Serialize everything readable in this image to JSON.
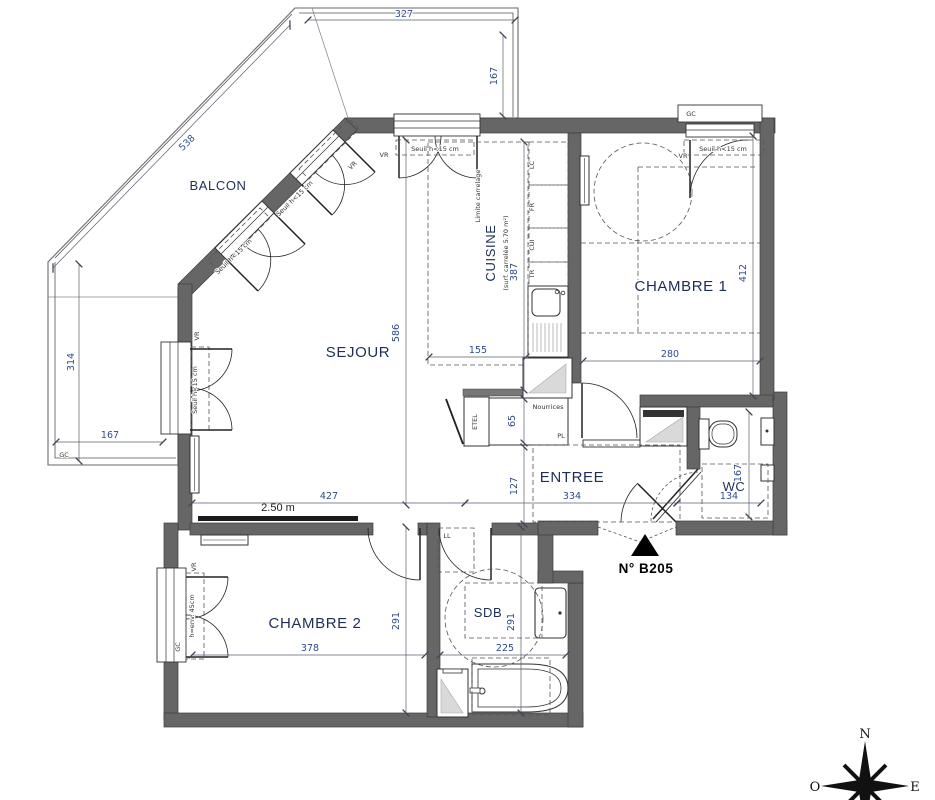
{
  "plan": {
    "unit_label": "N° B205",
    "scale_label": "2.50 m",
    "rooms": {
      "balcon": "BALCON",
      "sejour": "SEJOUR",
      "cuisine": "CUISINE",
      "cuisine_sub": "(surf. carrelée 5.70 m²)",
      "chambre1": "CHAMBRE 1",
      "chambre2": "CHAMBRE 2",
      "entree": "ENTREE",
      "wc": "WC",
      "sdb": "SDB"
    },
    "dims": {
      "balcon_top": "327",
      "balcon_right": "167",
      "balcon_diag": "538",
      "balcon_left": "314",
      "balcon_bottom": "167",
      "sejour_w": "427",
      "sejour_h": "586",
      "cuisine_w": "155",
      "cuisine_h": "387",
      "ch1_w": "280",
      "ch1_h": "412",
      "entree_w": "334",
      "entree_h": "127",
      "nourrices_d": "65",
      "wc_w": "134",
      "wc_h": "167",
      "ch2_w": "378",
      "ch2_h": "291",
      "sdb_w": "225",
      "sdb_h": "291"
    },
    "annotations": {
      "seuil": "Seuil h<15 cm",
      "vr": "VR",
      "gc": "GC",
      "ll": "LL",
      "lc": "LC",
      "fr": "FR",
      "cui": "CUI",
      "tr": "TR",
      "etel": "ETEL",
      "nourrices": "Nourrices",
      "pl": "PL",
      "limite_carrelage": "Limite carrelage",
      "hauteur_allege": "h=env. 45cm"
    },
    "compass": {
      "n": "N",
      "o": "O",
      "e": "E"
    },
    "colors": {
      "wall": "#666666",
      "dim_text": "#2e4a8c",
      "room_text": "#1d2f55",
      "hatch": "#8a8a8a"
    }
  }
}
